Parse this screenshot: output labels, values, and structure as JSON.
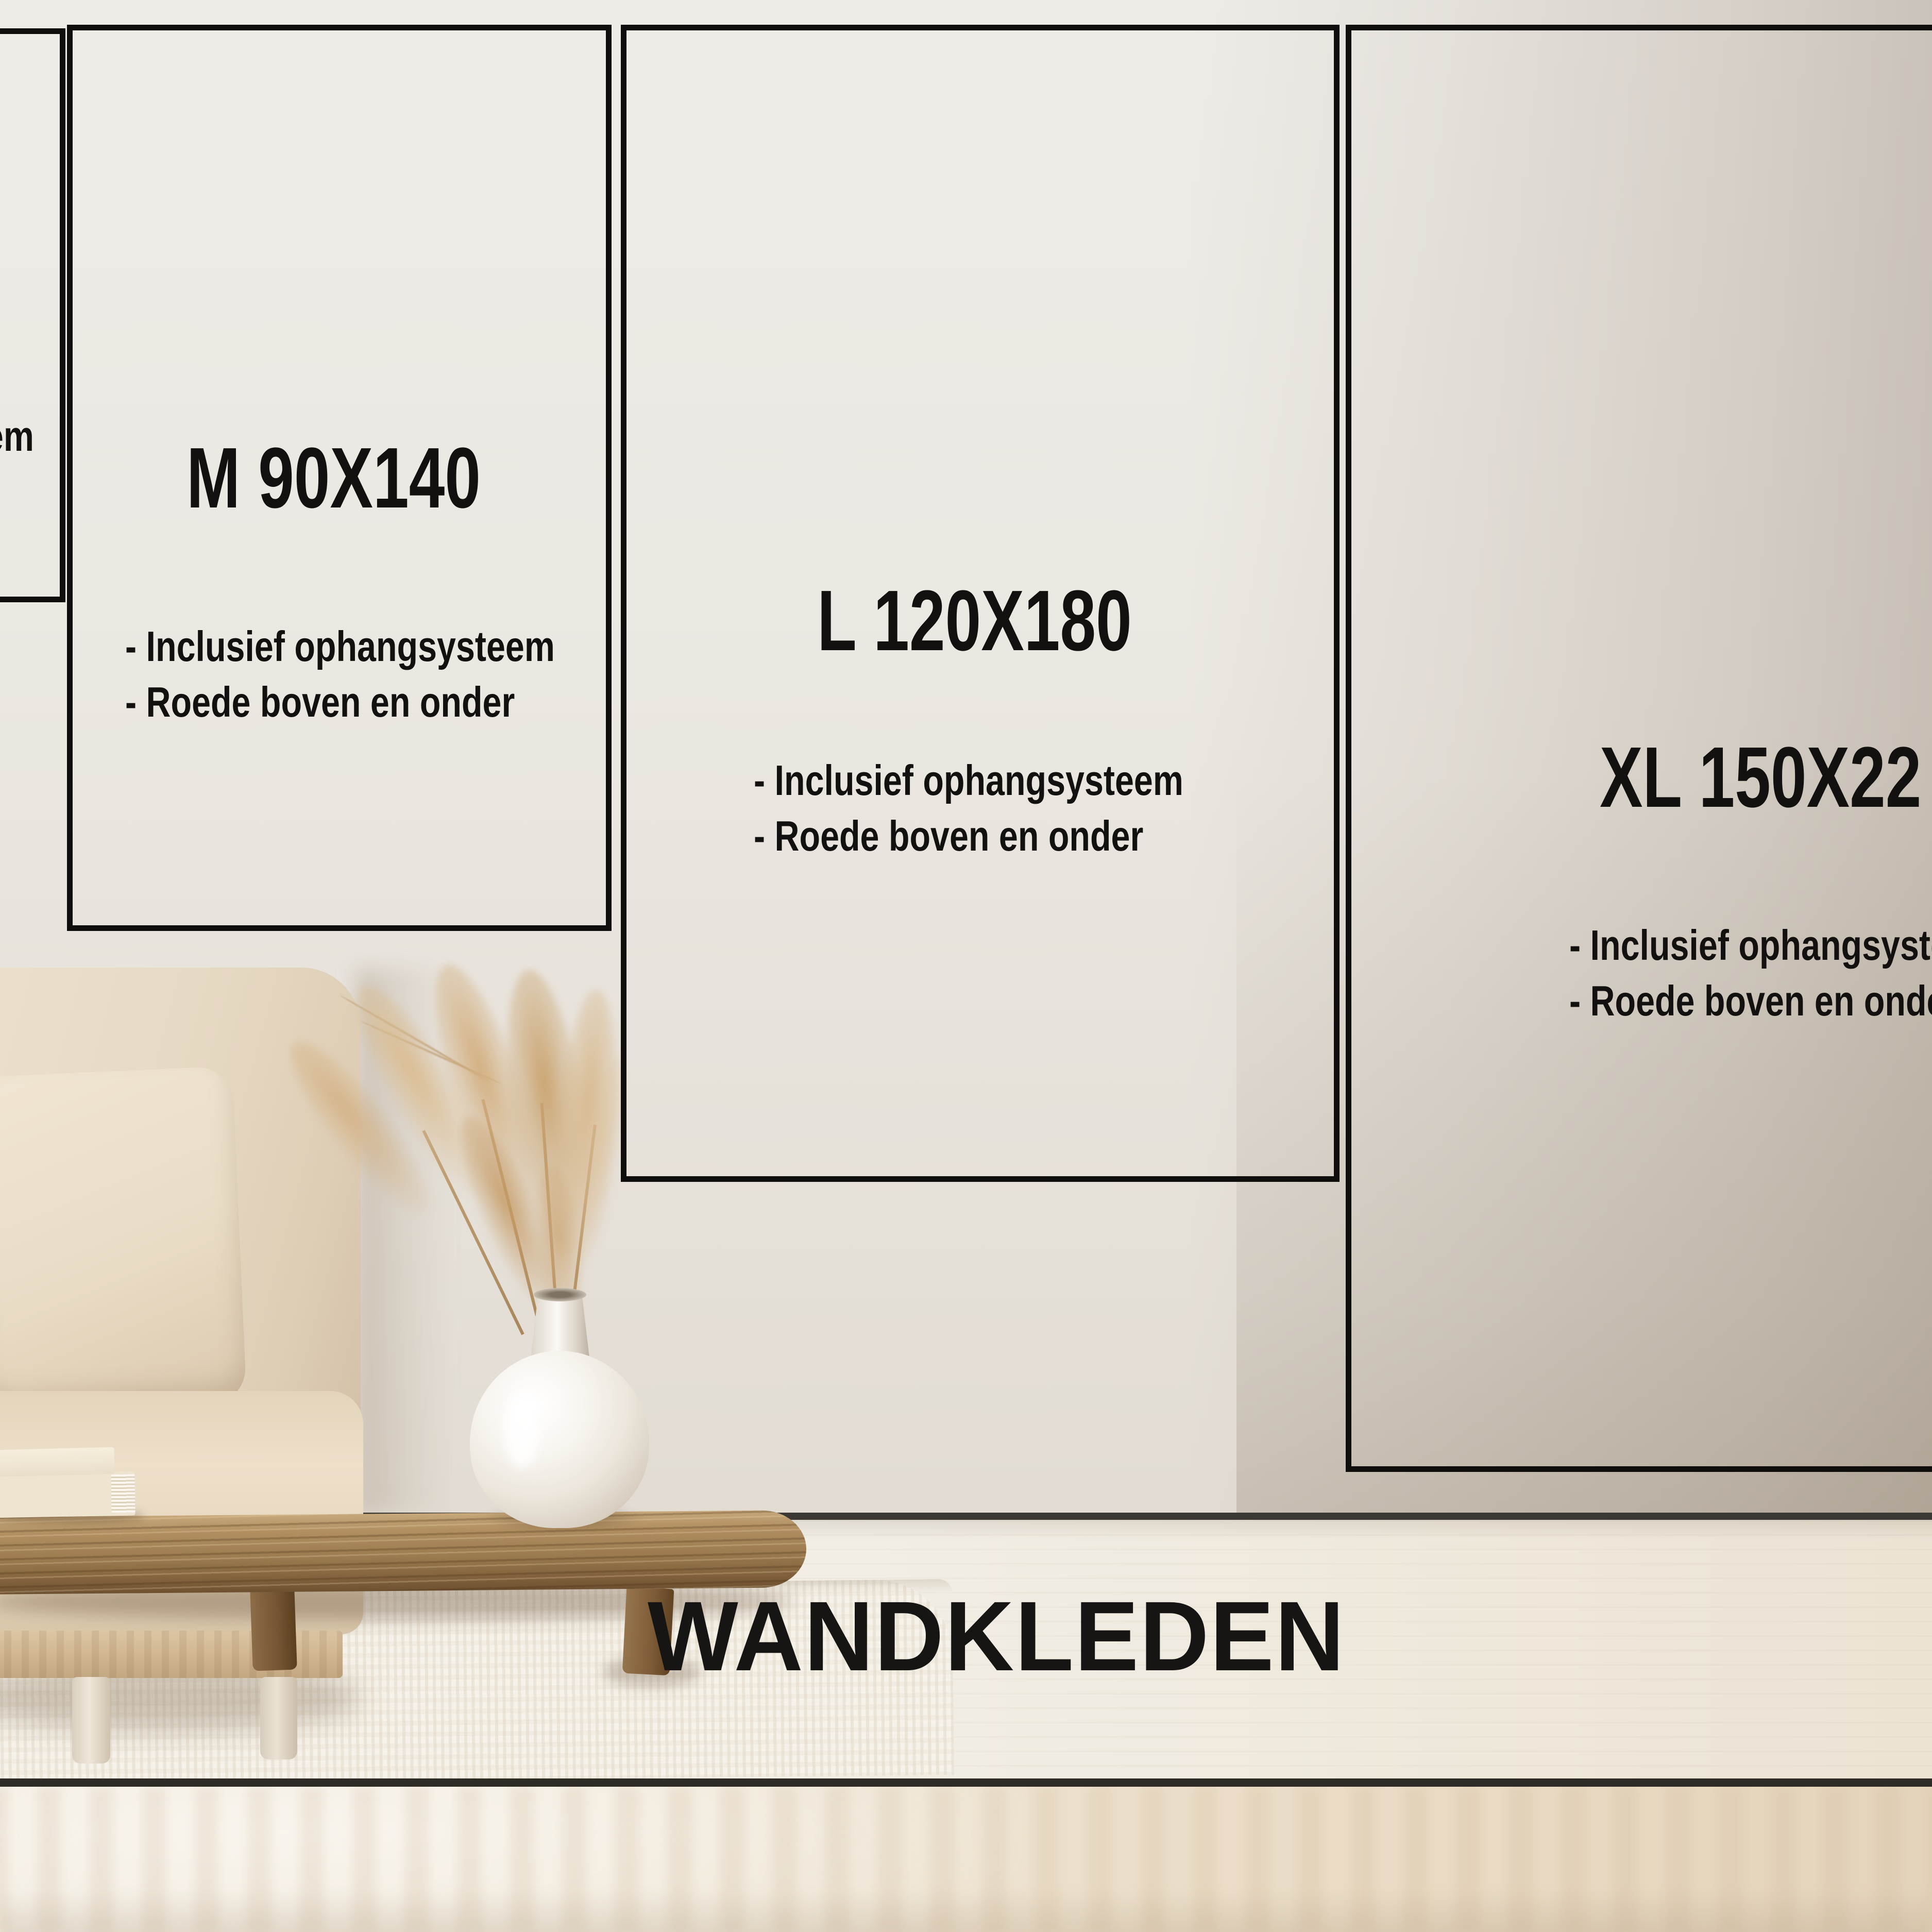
{
  "title": "WANDKLEDEN",
  "panels": {
    "s": {
      "bullets": [
        "- Inclusief ophangsysteem",
        "- Roede boven en onder"
      ],
      "visible_fragment": "em"
    },
    "m": {
      "label": "M 90X140",
      "bullets": [
        "- Inclusief ophangsysteem",
        "- Roede boven en onder"
      ]
    },
    "l": {
      "label": "L 120X180",
      "bullets": [
        "- Inclusief ophangsysteem",
        "- Roede boven en onder"
      ]
    },
    "xl": {
      "label": "XL 150X22",
      "bullets": [
        "- Inclusief ophangsysteem",
        "- Roede boven en onder"
      ]
    }
  },
  "colors": {
    "frame": "#0f0e0c",
    "text": "#13110f",
    "title_text": "#161513",
    "wall_light": "#efece8",
    "wall_dark_right": "#cdc4b8",
    "baseboard": "#3c3833",
    "floor": "#f1ece3",
    "floor_edge_line": "#2f2b26",
    "rug": "#f6f2e9",
    "sofa_fabric": "#e7dac5",
    "table_wood": "#9b7b4f",
    "pampas": "#d0ab78",
    "vase_ceramic": "#f6f3ee"
  }
}
